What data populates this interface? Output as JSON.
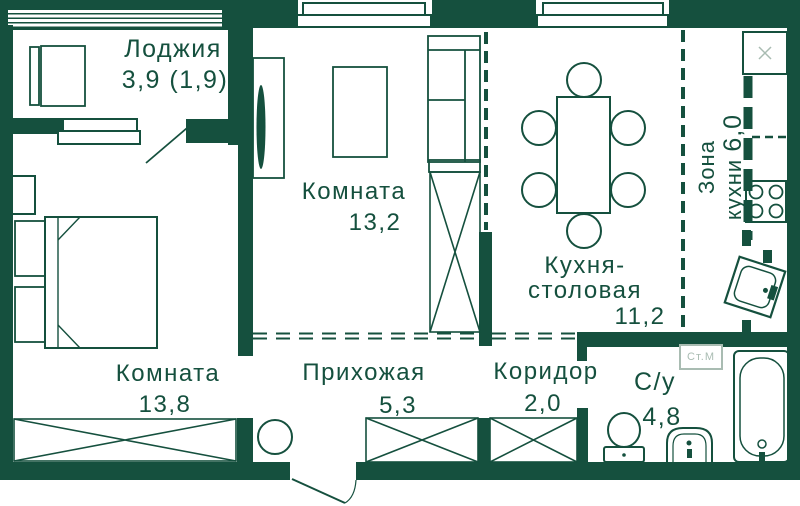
{
  "colors": {
    "wall": "#15503E",
    "text": "#15503E",
    "muted": "#A9BCB2",
    "floor": "#FFFFFF"
  },
  "rooms": {
    "loggia": {
      "name": "Лоджия",
      "area": "3,9 (1,9)"
    },
    "room_top": {
      "name": "Комната",
      "area": "13,2"
    },
    "kitchen_dining": {
      "name_line1": "Кухня-",
      "name_line2": "столовая",
      "area": "11,2"
    },
    "kitchen_zone": {
      "word1": "Зона",
      "word2": "кухни",
      "area": "6,0"
    },
    "room_bottom": {
      "name": "Комната",
      "area": "13,8"
    },
    "hallway": {
      "name": "Прихожая",
      "area": "5,3"
    },
    "corridor": {
      "name": "Коридор",
      "area": "2,0"
    },
    "bathroom": {
      "name": "С/у",
      "area": "4,8"
    }
  },
  "appliances": {
    "washing_machine_label": "Ст.М"
  }
}
